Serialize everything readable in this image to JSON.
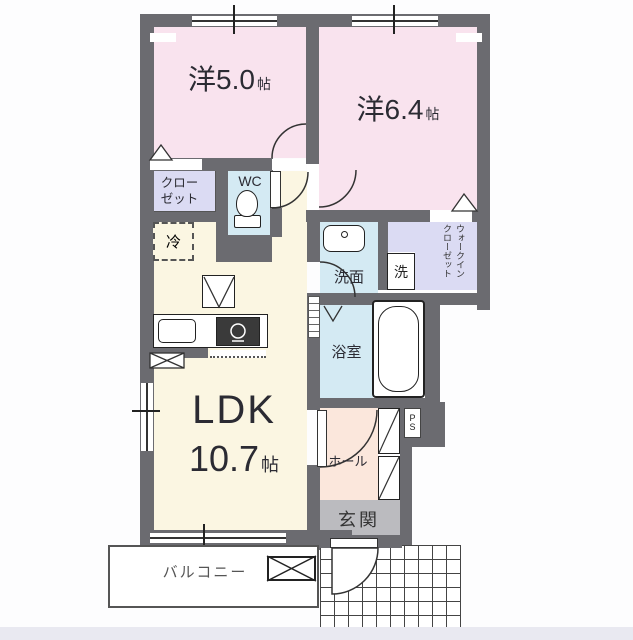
{
  "plan": {
    "title": "floor-plan",
    "rooms": {
      "western1": {
        "prefix": "洋",
        "size": "5.0",
        "unit": "帖"
      },
      "western2": {
        "prefix": "洋",
        "size": "6.4",
        "unit": "帖"
      },
      "ldk": {
        "name": "LDK",
        "size": "10.7",
        "unit": "帖"
      },
      "closet": {
        "line1": "クロー",
        "line2": "ゼット"
      },
      "wc": {
        "label": "WC"
      },
      "refrigerator": {
        "label": "冷"
      },
      "washroom": {
        "label": "洗面"
      },
      "washer": {
        "label": "洗"
      },
      "bathroom": {
        "label": "浴室"
      },
      "walk_in_closet": {
        "line1": "ウォークイン",
        "line2": "クローゼット"
      },
      "pipe_space": {
        "label": "PS"
      },
      "hall": {
        "label": "ホール"
      },
      "entrance": {
        "label": "玄関"
      },
      "balcony": {
        "label": "バルコニー"
      }
    },
    "colors": {
      "wall": "#6B6B70",
      "room_pink": "#F9E3EE",
      "ldk_cream": "#FBF6E2",
      "water_blue": "#D4EAF3",
      "closet_lavender": "#DBDBF3",
      "hall_peach": "#FBE7DC",
      "entrance_gray": "#BBBBBF",
      "footer_strip": "#E9E9F1",
      "line": "#333333"
    }
  }
}
